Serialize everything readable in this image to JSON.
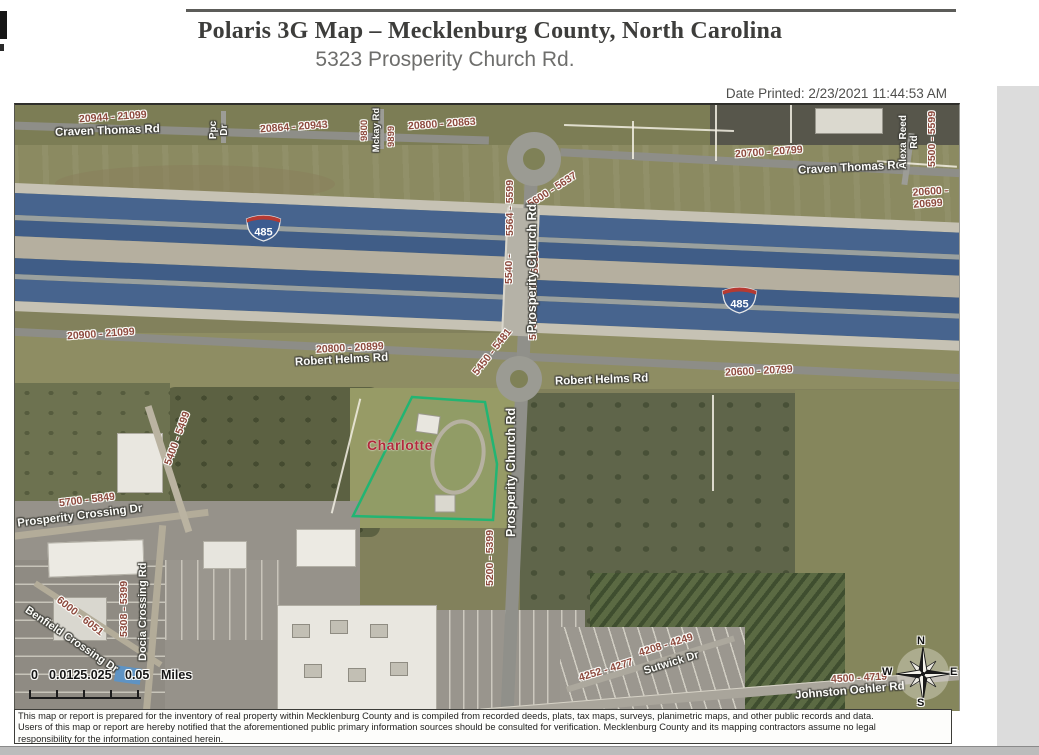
{
  "header": {
    "title": "Polaris 3G Map – Mecklenburg County, North Carolina",
    "subtitle": "5323 Prosperity Church Rd.",
    "date_printed": "Date Printed: 2/23/2021 11:44:53 AM"
  },
  "map": {
    "city_label": "Charlotte",
    "parcel_outline_color": "#22b573",
    "interstate": {
      "number": "485"
    },
    "roads": {
      "craven_thomas": "Craven Thomas Rd",
      "ppc": "Ppc Dr",
      "mckay": "Mckay Rd",
      "alexa_reed": "Alexa Reed Rd",
      "robert_helms": "Robert Helms Rd",
      "prosperity_church": "Prosperity Church Rd",
      "prosperity_crossing": "Prosperity Crossing Dr",
      "benfield_crossing": "Benfield Crossing Dr",
      "docia_crossing": "Docia Crossing Rd",
      "sutwick": "Sutwick Dr",
      "johnston_oehler": "Johnston Oehler Rd"
    },
    "address_ranges": {
      "a20944_21099": "20944 - 21099",
      "a20864_20943": "20864 - 20943",
      "a20800_20863": "20800 - 20863",
      "a9800": "9800",
      "a9899": "9899",
      "a20700_20799": "20700 - 20799",
      "a5500_5599": "5500 - 5599",
      "a20600_20699": "20600 - 20699",
      "a20900_21099": "20900 - 21099",
      "a20800_20899": "20800 - 20899",
      "a20600_20799": "20600 - 20799",
      "a5600_5637": "5600 - 5637",
      "a5564_5599": "5564 - 5599",
      "a5540": "5540 -",
      "a5563": "5563",
      "a5500_5539": "5500 - 5539",
      "a5450_5481": "5450 - 5481",
      "a5200_5399": "5200 - 5399",
      "a5400_5499": "5400 - 5499",
      "a5700_5849": "5700 - 5849",
      "a6000_6051": "6000 - 6051",
      "a5308_5399": "5308 - 5399",
      "a4252_4277": "4252 - 4277",
      "a4208_4249": "4208 - 4249",
      "a4500_4719": "4500 - 4719"
    },
    "scale_bar": {
      "zero": "0",
      "mid": "0.0125.025",
      "max": "0.05",
      "units": "Miles"
    },
    "compass": {
      "n": "N",
      "e": "E",
      "s": "S",
      "w": "W"
    }
  },
  "disclaimer": {
    "line1": "This map or report is prepared for the inventory of real property within Mecklenburg County and is compiled from recorded deeds, plats, tax maps, surveys, planimetric maps, and other public records and data.",
    "line2": "Users of this map or report are hereby notified that the aforementioned public primary information sources should be consulted for verification. Mecklenburg County and its mapping contractors assume no legal",
    "line3": "responsibility for the information contained herein."
  }
}
